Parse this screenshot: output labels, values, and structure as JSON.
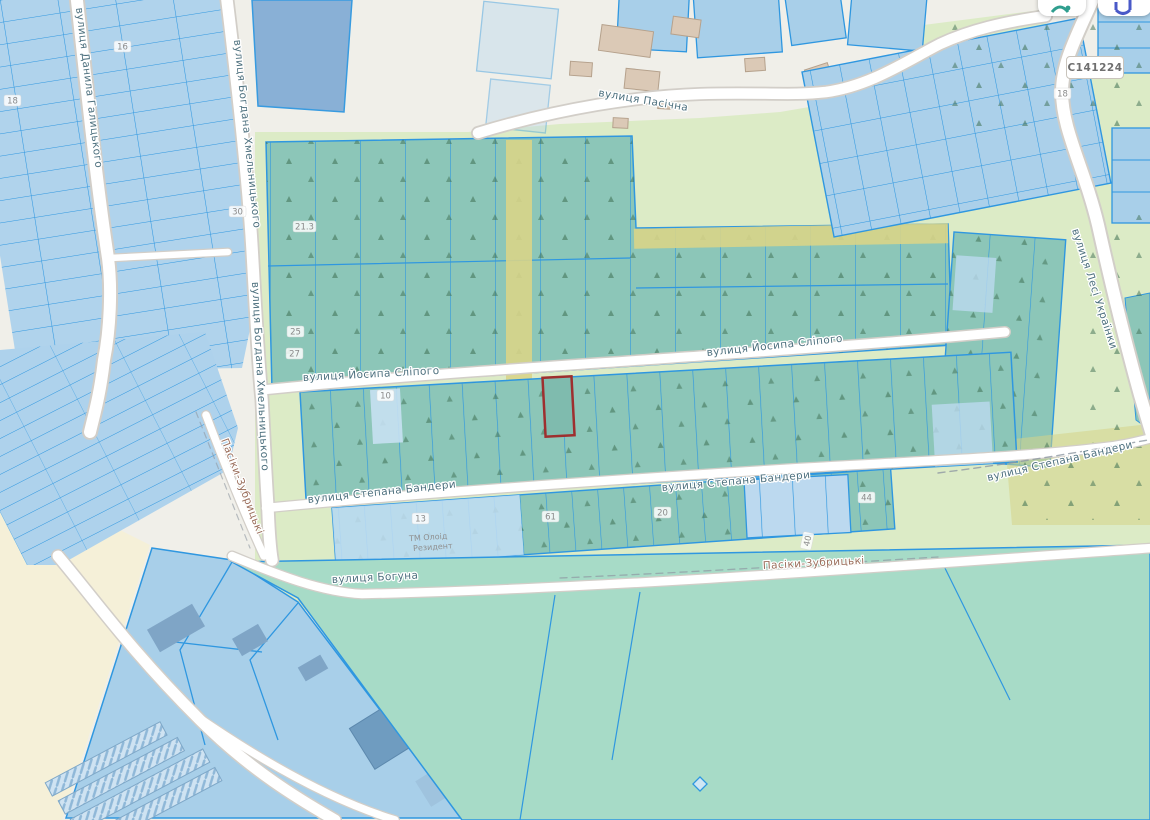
{
  "app": {
    "type": "cadastral-map-viewer"
  },
  "road_badge": {
    "ref": "C141224"
  },
  "streets": {
    "pasichna": "вулиця Пасічна",
    "slipoho": "вулиця Йосипа Сліпого",
    "bandery": "вулиця Степана Бандери",
    "bohuna": "вулиця Богуна",
    "halytskoho": "вулиця Данила Галицького",
    "khmelnytskoho": "вулиця Богдана Хмельницького",
    "lesi_ukrainky": "вулиця Лесі Українки",
    "pasiky_zubrytski": "Пасіки-Зубрицькі"
  },
  "parcels": {
    "n16": "16",
    "n18_left": "18",
    "n30": "30",
    "n21": "21.3",
    "n25": "25",
    "n27": "27",
    "n10": "10",
    "n13": "13",
    "n61": "61",
    "n20": "20",
    "n40": "40",
    "n44": "44",
    "n18_right": "18"
  },
  "poi": {
    "name_line1": "ТМ Олоід",
    "name_line2": "Резидент"
  },
  "colors": {
    "parcel_fill": "#aacfe8",
    "parcel_border": "#2f97e0",
    "garden_fill": "#8cc6b8",
    "selected_parcel_outline": "#9e2f2f",
    "road_fill": "#ffffff",
    "field_fill": "#a7dbc7",
    "lane_fill": "#d8d488",
    "background_green": "#dcebc6"
  }
}
